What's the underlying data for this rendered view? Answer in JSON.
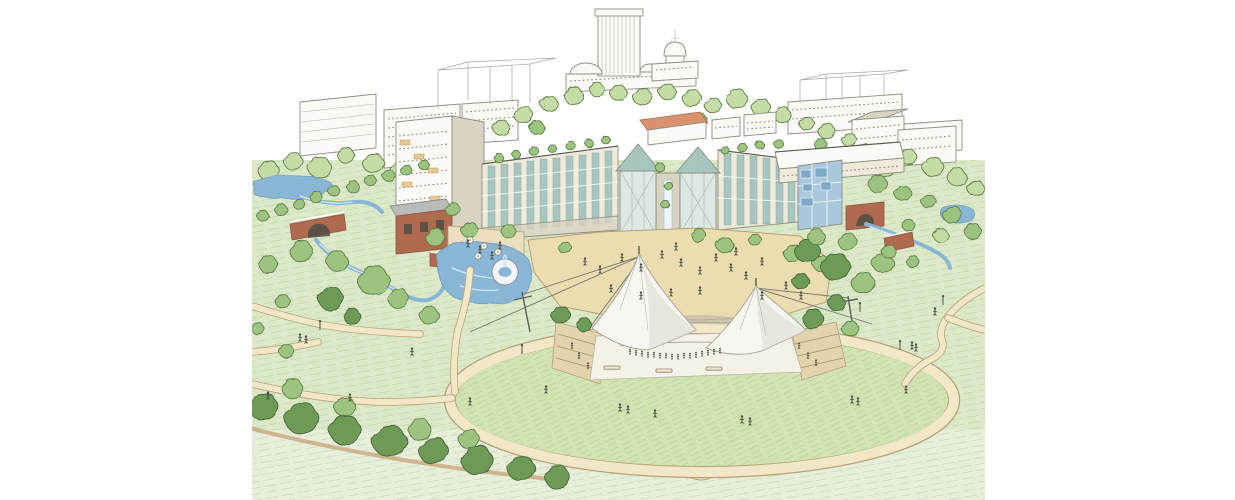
{
  "image": {
    "kind": "architectural concept rendering",
    "medium": "watercolor and ink aerial perspective sketch",
    "subject": "urban park master plan: great lawn with fabric-canopy amphitheater, ponds, streams and brick bridges, central plaza, twin mid-rise buildings with glass pyramid atria, and a capitol-dome city skyline behind",
    "text_content": "none (no text is rendered in the image)"
  },
  "landmarks": [
    "capitol-tower",
    "old-capitol-dome",
    "office-buildings",
    "wireframe-future-buildings",
    "apartment-building",
    "left-wing-building",
    "right-wing-building",
    "atrium-pyramids",
    "central-cascade",
    "glass-annex",
    "brick-arch-bridge",
    "park-pavilion",
    "terrace-cafe",
    "pond-with-fountain",
    "central-plaza",
    "amphitheater-canopy",
    "stage",
    "great-lawn",
    "ring-path",
    "creek",
    "right-stream-bridge",
    "tree-bands",
    "walking-paths"
  ],
  "palette": {
    "paper": "#ffffff",
    "line": "#8d8d83",
    "ink": "#55584e",
    "grass": "#dce9c9",
    "grassIn": "#d2e3b2",
    "grassPale": "#e7efdb",
    "hatch": "#a9c58d",
    "treeLight": "#c5dca6",
    "treeMid": "#9dc47f",
    "treeDark": "#6d9b57",
    "treeLine": "#5d8049",
    "water": "#8ab6d6",
    "waterHi": "#cfe4f2",
    "pathFill": "#f2e7c6",
    "pathEdge": "#b7a077",
    "plaza": "#ecddb0",
    "brick": "#b06a50",
    "brickDark": "#8f5340",
    "roofGray": "#b9bdb9",
    "roofRed": "#d8926e",
    "facade": "#efead9",
    "facadeShade": "#d9d3c1",
    "glassTeal": "#a7c6bf",
    "glassBlue": "#a9c8dc",
    "glassDeep": "#7fa9c8",
    "canvasWhite": "#f7f6f1",
    "canvasShade": "#dcd9cf",
    "figure": "#4c4f46"
  },
  "scene": {
    "background_trees": [
      [
        268,
        172,
        1.0,
        "L"
      ],
      [
        292,
        162,
        0.9,
        "L"
      ],
      [
        318,
        168,
        1.1,
        "L"
      ],
      [
        345,
        156,
        0.8,
        "L"
      ],
      [
        372,
        164,
        1.0,
        "L"
      ],
      [
        398,
        170,
        0.9,
        "L"
      ],
      [
        424,
        163,
        0.8,
        "L"
      ],
      [
        448,
        155,
        0.7,
        "L"
      ],
      [
        470,
        148,
        0.8,
        "L"
      ],
      [
        500,
        128,
        0.8,
        "L"
      ],
      [
        523,
        116,
        0.9,
        "L"
      ],
      [
        548,
        104,
        0.8,
        "L"
      ],
      [
        572,
        96,
        0.9,
        "L"
      ],
      [
        596,
        90,
        0.7,
        "L"
      ],
      [
        618,
        94,
        0.8,
        "L"
      ],
      [
        642,
        98,
        0.9,
        "L"
      ],
      [
        666,
        92,
        0.8,
        "L"
      ],
      [
        690,
        98,
        0.9,
        "L"
      ],
      [
        712,
        106,
        0.8,
        "L"
      ],
      [
        736,
        100,
        1.0,
        "L"
      ],
      [
        760,
        108,
        0.9,
        "L"
      ],
      [
        782,
        116,
        0.8,
        "L"
      ],
      [
        806,
        124,
        0.7,
        "L"
      ],
      [
        826,
        132,
        0.8,
        "L"
      ],
      [
        848,
        140,
        0.7,
        "L"
      ],
      [
        884,
        168,
        0.9,
        "L"
      ],
      [
        908,
        158,
        0.8,
        "L"
      ],
      [
        932,
        168,
        1.0,
        "L"
      ],
      [
        956,
        178,
        0.9,
        "L"
      ],
      [
        974,
        188,
        0.8,
        "L"
      ],
      [
        536,
        128,
        0.7,
        "M"
      ],
      [
        700,
        120,
        0.6,
        "M"
      ],
      [
        760,
        130,
        0.6,
        "M"
      ],
      [
        820,
        145,
        0.6,
        "M"
      ],
      [
        864,
        152,
        0.7,
        "L"
      ]
    ],
    "midground_trees": [
      [
        262,
        216,
        0.55,
        "M"
      ],
      [
        280,
        210,
        0.6,
        "M"
      ],
      [
        298,
        204,
        0.55,
        "M"
      ],
      [
        316,
        198,
        0.6,
        "M"
      ],
      [
        334,
        192,
        0.55,
        "M"
      ],
      [
        352,
        187,
        0.6,
        "M"
      ],
      [
        370,
        181,
        0.55,
        "M"
      ],
      [
        388,
        176,
        0.6,
        "M"
      ],
      [
        406,
        171,
        0.55,
        "M"
      ],
      [
        424,
        166,
        0.5,
        "M"
      ],
      [
        498,
        158,
        0.45,
        "M"
      ],
      [
        516,
        155,
        0.4,
        "M"
      ],
      [
        534,
        152,
        0.45,
        "M"
      ],
      [
        552,
        149,
        0.4,
        "M"
      ],
      [
        570,
        146,
        0.45,
        "M"
      ],
      [
        588,
        143,
        0.4,
        "M"
      ],
      [
        606,
        141,
        0.4,
        "M"
      ],
      [
        724,
        150,
        0.4,
        "M"
      ],
      [
        742,
        148,
        0.45,
        "M"
      ],
      [
        760,
        146,
        0.4,
        "M"
      ],
      [
        778,
        144,
        0.45,
        "M"
      ],
      [
        660,
        168,
        0.45,
        "M"
      ],
      [
        668,
        186,
        0.4,
        "M"
      ],
      [
        664,
        204,
        0.4,
        "M"
      ],
      [
        300,
        252,
        1.1,
        "M"
      ],
      [
        268,
        266,
        0.9,
        "M"
      ],
      [
        336,
        262,
        1.0,
        "M"
      ],
      [
        372,
        282,
        1.5,
        "M"
      ],
      [
        330,
        300,
        1.2,
        "D"
      ],
      [
        398,
        300,
        1.0,
        "M"
      ],
      [
        428,
        316,
        0.9,
        "M"
      ],
      [
        282,
        302,
        0.7,
        "M"
      ],
      [
        352,
        318,
        0.8,
        "D"
      ],
      [
        434,
        238,
        0.9,
        "M"
      ],
      [
        468,
        230,
        0.8,
        "M"
      ],
      [
        452,
        210,
        0.7,
        "M"
      ],
      [
        508,
        232,
        0.7,
        "M"
      ],
      [
        698,
        236,
        0.7,
        "M"
      ],
      [
        724,
        246,
        0.8,
        "M"
      ],
      [
        754,
        240,
        0.6,
        "M"
      ],
      [
        792,
        254,
        0.9,
        "M"
      ],
      [
        820,
        264,
        0.8,
        "M"
      ],
      [
        564,
        248,
        0.6,
        "M"
      ]
    ],
    "foreground_trees": [
      [
        560,
        316,
        0.9,
        "D"
      ],
      [
        584,
        326,
        0.7,
        "D"
      ],
      [
        812,
        320,
        1.0,
        "D"
      ],
      [
        836,
        304,
        0.8,
        "D"
      ],
      [
        850,
        330,
        0.8,
        "M"
      ],
      [
        806,
        252,
        1.2,
        "D"
      ],
      [
        834,
        268,
        1.4,
        "D"
      ],
      [
        862,
        284,
        1.1,
        "M"
      ],
      [
        846,
        242,
        0.9,
        "M"
      ],
      [
        882,
        264,
        1.0,
        "M"
      ],
      [
        800,
        282,
        0.8,
        "D"
      ],
      [
        816,
        238,
        0.8,
        "M"
      ],
      [
        876,
        184,
        0.9,
        "M"
      ],
      [
        902,
        194,
        0.8,
        "M"
      ],
      [
        928,
        202,
        0.7,
        "M"
      ],
      [
        952,
        216,
        0.9,
        "M"
      ],
      [
        972,
        232,
        0.8,
        "M"
      ],
      [
        940,
        236,
        0.7,
        "L"
      ],
      [
        908,
        226,
        0.6,
        "M"
      ],
      [
        888,
        252,
        0.7,
        "M"
      ],
      [
        912,
        262,
        0.6,
        "M"
      ],
      [
        262,
        408,
        1.4,
        "D"
      ],
      [
        300,
        420,
        1.6,
        "D"
      ],
      [
        344,
        432,
        1.5,
        "D"
      ],
      [
        388,
        443,
        1.6,
        "D"
      ],
      [
        432,
        452,
        1.4,
        "D"
      ],
      [
        476,
        462,
        1.5,
        "D"
      ],
      [
        520,
        470,
        1.3,
        "D"
      ],
      [
        556,
        478,
        1.2,
        "D"
      ],
      [
        292,
        390,
        1.0,
        "M"
      ],
      [
        418,
        430,
        1.1,
        "M"
      ],
      [
        344,
        408,
        1.0,
        "M"
      ],
      [
        468,
        440,
        1.0,
        "M"
      ],
      [
        286,
        352,
        0.7,
        "M"
      ],
      [
        258,
        330,
        0.6,
        "M"
      ]
    ],
    "people": [
      [
        585,
        262
      ],
      [
        600,
        270
      ],
      [
        622,
        258
      ],
      [
        641,
        268
      ],
      [
        662,
        255
      ],
      [
        681,
        263
      ],
      [
        700,
        271
      ],
      [
        716,
        258
      ],
      [
        731,
        268
      ],
      [
        746,
        276
      ],
      [
        762,
        262
      ],
      [
        700,
        291
      ],
      [
        671,
        293
      ],
      [
        641,
        296
      ],
      [
        611,
        289
      ],
      [
        762,
        296
      ],
      [
        786,
        286
      ],
      [
        801,
        296
      ],
      [
        676,
        247
      ],
      [
        736,
        252
      ],
      [
        630,
        352,
        0.7
      ],
      [
        636,
        353,
        0.7
      ],
      [
        642,
        354,
        0.7
      ],
      [
        648,
        355,
        0.7
      ],
      [
        654,
        355,
        0.7
      ],
      [
        660,
        356,
        0.7
      ],
      [
        666,
        356,
        0.7
      ],
      [
        672,
        357,
        0.7
      ],
      [
        678,
        357,
        0.7
      ],
      [
        684,
        356,
        0.7
      ],
      [
        690,
        356,
        0.7
      ],
      [
        696,
        355,
        0.7
      ],
      [
        702,
        354,
        0.7
      ],
      [
        708,
        353,
        0.7
      ],
      [
        714,
        352,
        0.7
      ],
      [
        720,
        351,
        0.7
      ],
      [
        572,
        346,
        0.8
      ],
      [
        579,
        356,
        0.8
      ],
      [
        588,
        366,
        0.8
      ],
      [
        799,
        346,
        0.8
      ],
      [
        808,
        356,
        0.8
      ],
      [
        816,
        363,
        0.8
      ],
      [
        546,
        390
      ],
      [
        620,
        408
      ],
      [
        628,
        410
      ],
      [
        655,
        414
      ],
      [
        742,
        420
      ],
      [
        750,
        422
      ],
      [
        852,
        400
      ],
      [
        858,
        402
      ],
      [
        470,
        402
      ],
      [
        906,
        390
      ],
      [
        300,
        338
      ],
      [
        306,
        340
      ],
      [
        412,
        352
      ],
      [
        350,
        398
      ],
      [
        268,
        396
      ],
      [
        935,
        312
      ],
      [
        912,
        346
      ],
      [
        916,
        348
      ],
      [
        468,
        244
      ],
      [
        480,
        250
      ],
      [
        492,
        256
      ],
      [
        500,
        246
      ]
    ],
    "lamps": [
      [
        320,
        330
      ],
      [
        522,
        354
      ],
      [
        943,
        305
      ],
      [
        900,
        350
      ],
      [
        860,
        312
      ]
    ],
    "benches": [
      [
        612,
        368
      ],
      [
        664,
        371
      ],
      [
        714,
        369
      ]
    ],
    "umbrellas": [
      [
        470,
        240
      ],
      [
        484,
        246
      ],
      [
        498,
        252
      ],
      [
        478,
        256
      ]
    ]
  }
}
